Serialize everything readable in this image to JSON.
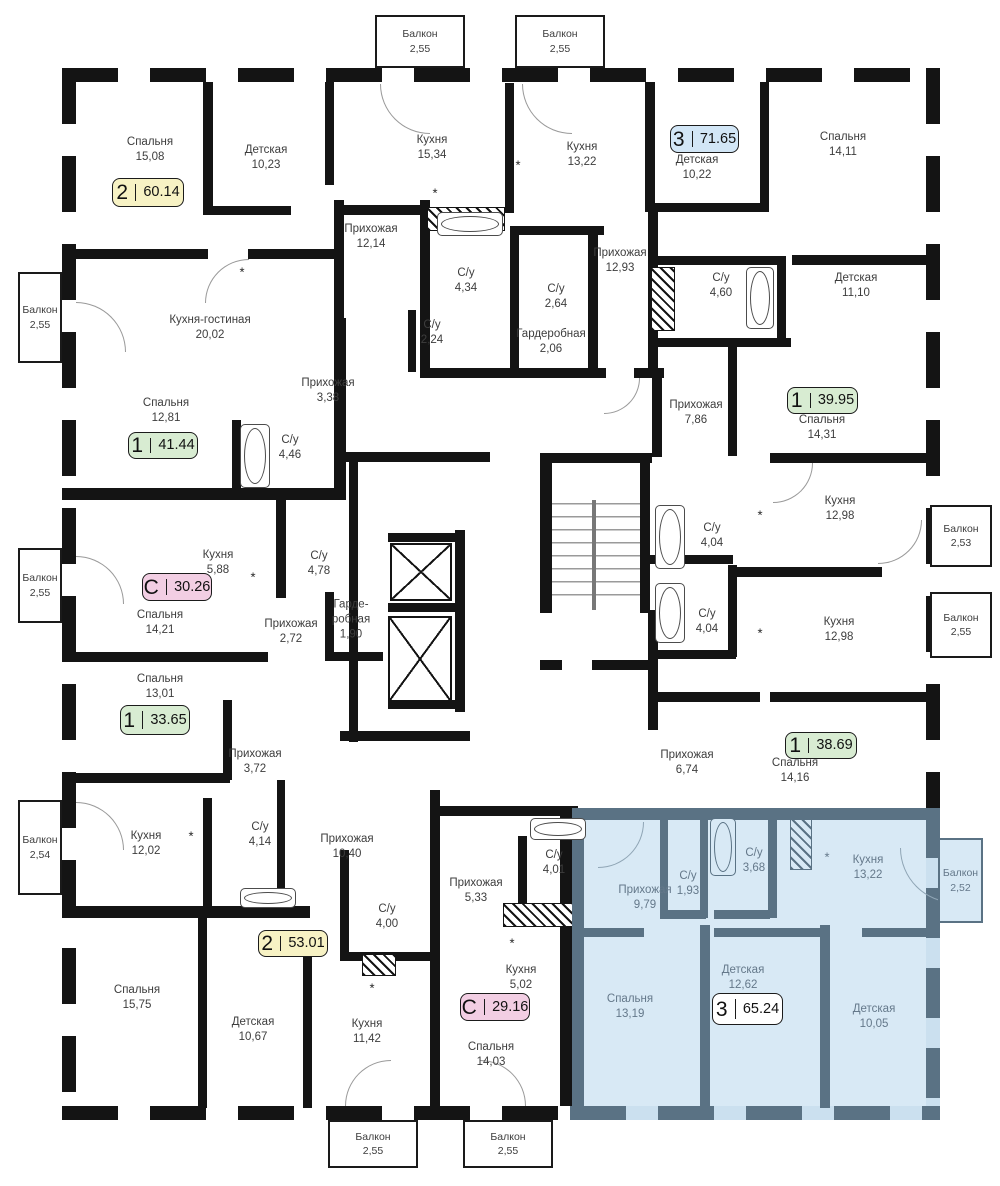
{
  "plan": {
    "wall_color": "#141414",
    "highlight_wall_color": "#5A7284",
    "highlight_fill": "#D8E9F5",
    "label_color": "#3d3d3d",
    "highlight_label_color": "#64788A"
  },
  "apartments": [
    {
      "type": "2",
      "area": "60.14",
      "color": "#F7F2C4",
      "x": 112,
      "y": 178,
      "w": 72,
      "h": 29,
      "highlighted": false
    },
    {
      "type": "3",
      "area": "71.65",
      "color": "#D2E6F6",
      "x": 670,
      "y": 125,
      "w": 69,
      "h": 28,
      "highlighted": false
    },
    {
      "type": "1",
      "area": "41.44",
      "color": "#D8ECD2",
      "x": 128,
      "y": 432,
      "w": 70,
      "h": 27,
      "highlighted": false
    },
    {
      "type": "1",
      "area": "39.95",
      "color": "#D8ECD2",
      "x": 787,
      "y": 387,
      "w": 71,
      "h": 27,
      "highlighted": false
    },
    {
      "type": "С",
      "area": "30.26",
      "color": "#F2CEE3",
      "x": 142,
      "y": 573,
      "w": 70,
      "h": 28,
      "highlighted": false
    },
    {
      "type": "1",
      "area": "33.65",
      "color": "#D8ECD2",
      "x": 120,
      "y": 705,
      "w": 70,
      "h": 30,
      "highlighted": false
    },
    {
      "type": "1",
      "area": "38.69",
      "color": "#D8ECD2",
      "x": 785,
      "y": 732,
      "w": 72,
      "h": 27,
      "highlighted": false
    },
    {
      "type": "2",
      "area": "53.01",
      "color": "#F7F2C4",
      "x": 258,
      "y": 930,
      "w": 70,
      "h": 27,
      "highlighted": false
    },
    {
      "type": "С",
      "area": "29.16",
      "color": "#F2CEE3",
      "x": 460,
      "y": 993,
      "w": 70,
      "h": 28,
      "highlighted": false
    },
    {
      "type": "3",
      "area": "65.24",
      "color": "#FFFFFF",
      "x": 712,
      "y": 993,
      "w": 71,
      "h": 32,
      "highlighted": true
    }
  ],
  "rooms": [
    {
      "name": "Спальня",
      "area": "15,08",
      "x": 150,
      "y": 150,
      "highlighted": false
    },
    {
      "name": "Детская",
      "area": "10,23",
      "x": 266,
      "y": 158,
      "highlighted": false
    },
    {
      "name": "Кухня",
      "area": "15,34",
      "x": 432,
      "y": 148,
      "highlighted": false
    },
    {
      "name": "Кухня",
      "area": "13,22",
      "x": 582,
      "y": 155,
      "highlighted": false
    },
    {
      "name": "Детская",
      "area": "10,22",
      "x": 697,
      "y": 168,
      "highlighted": false
    },
    {
      "name": "Спальня",
      "area": "14,11",
      "x": 843,
      "y": 145,
      "highlighted": false
    },
    {
      "name": "Прихожая",
      "area": "12,14",
      "x": 371,
      "y": 237,
      "highlighted": false
    },
    {
      "name": "Прихожая",
      "area": "12,93",
      "x": 620,
      "y": 261,
      "highlighted": false
    },
    {
      "name": "С/у",
      "area": "4,34",
      "x": 466,
      "y": 281,
      "highlighted": false
    },
    {
      "name": "С/у",
      "area": "2,64",
      "x": 556,
      "y": 297,
      "highlighted": false
    },
    {
      "name": "С/у",
      "area": "4,60",
      "x": 721,
      "y": 286,
      "highlighted": false
    },
    {
      "name": "Детская",
      "area": "11,10",
      "x": 856,
      "y": 286,
      "highlighted": false
    },
    {
      "name": "Кухня-гостиная",
      "area": "20,02",
      "x": 210,
      "y": 328,
      "highlighted": false
    },
    {
      "name": "С/у",
      "area": "2,24",
      "x": 432,
      "y": 333,
      "highlighted": false
    },
    {
      "name": "Гардеробная",
      "area": "2,06",
      "x": 551,
      "y": 342,
      "highlighted": false
    },
    {
      "name": "Прихожая",
      "area": "3,38",
      "x": 328,
      "y": 391,
      "highlighted": false
    },
    {
      "name": "Прихожая",
      "area": "7,86",
      "x": 696,
      "y": 413,
      "highlighted": false
    },
    {
      "name": "Спальня",
      "area": "12,81",
      "x": 166,
      "y": 411,
      "highlighted": false
    },
    {
      "name": "Спальня",
      "area": "14,31",
      "x": 822,
      "y": 428,
      "highlighted": false
    },
    {
      "name": "С/у",
      "area": "4,46",
      "x": 290,
      "y": 448,
      "highlighted": false
    },
    {
      "name": "Кухня",
      "area": "12,98",
      "x": 840,
      "y": 509,
      "highlighted": false
    },
    {
      "name": "С/у",
      "area": "4,04",
      "x": 712,
      "y": 536,
      "highlighted": false
    },
    {
      "name": "Кухня",
      "area": "5,88",
      "x": 218,
      "y": 563,
      "highlighted": false
    },
    {
      "name": "С/у",
      "area": "4,78",
      "x": 319,
      "y": 564,
      "highlighted": false
    },
    {
      "name": "Спальня",
      "area": "14,21",
      "x": 160,
      "y": 623,
      "highlighted": false
    },
    {
      "name": "Прихожая",
      "area": "2,72",
      "x": 291,
      "y": 632,
      "highlighted": false
    },
    {
      "name": "Гарде-\nробная",
      "area": "1,90",
      "x": 351,
      "y": 620,
      "highlighted": false
    },
    {
      "name": "С/у",
      "area": "4,04",
      "x": 707,
      "y": 622,
      "highlighted": false
    },
    {
      "name": "Кухня",
      "area": "12,98",
      "x": 839,
      "y": 630,
      "highlighted": false
    },
    {
      "name": "Спальня",
      "area": "13,01",
      "x": 160,
      "y": 687,
      "highlighted": false
    },
    {
      "name": "Прихожая",
      "area": "3,72",
      "x": 255,
      "y": 762,
      "highlighted": false
    },
    {
      "name": "Прихожая",
      "area": "6,74",
      "x": 687,
      "y": 763,
      "highlighted": false
    },
    {
      "name": "Спальня",
      "area": "14,16",
      "x": 795,
      "y": 771,
      "highlighted": false
    },
    {
      "name": "Кухня",
      "area": "12,02",
      "x": 146,
      "y": 844,
      "highlighted": false
    },
    {
      "name": "С/у",
      "area": "4,14",
      "x": 260,
      "y": 835,
      "highlighted": false
    },
    {
      "name": "Прихожая",
      "area": "10,40",
      "x": 347,
      "y": 847,
      "highlighted": false
    },
    {
      "name": "С/у",
      "area": "4,00",
      "x": 387,
      "y": 917,
      "highlighted": false
    },
    {
      "name": "Прихожая",
      "area": "5,33",
      "x": 476,
      "y": 891,
      "highlighted": false
    },
    {
      "name": "С/у",
      "area": "4,01",
      "x": 554,
      "y": 863,
      "highlighted": false
    },
    {
      "name": "Кухня",
      "area": "5,02",
      "x": 521,
      "y": 978,
      "highlighted": false
    },
    {
      "name": "Спальня",
      "area": "15,75",
      "x": 137,
      "y": 998,
      "highlighted": false
    },
    {
      "name": "Детская",
      "area": "10,67",
      "x": 253,
      "y": 1030,
      "highlighted": false
    },
    {
      "name": "Кухня",
      "area": "11,42",
      "x": 367,
      "y": 1032,
      "highlighted": false
    },
    {
      "name": "Спальня",
      "area": "14,03",
      "x": 491,
      "y": 1055,
      "highlighted": false
    },
    {
      "name": "Прихожая",
      "area": "9,79",
      "x": 645,
      "y": 898,
      "highlighted": true
    },
    {
      "name": "С/у",
      "area": "1,93",
      "x": 688,
      "y": 884,
      "highlighted": true
    },
    {
      "name": "С/у",
      "area": "3,68",
      "x": 754,
      "y": 861,
      "highlighted": true
    },
    {
      "name": "Кухня",
      "area": "13,22",
      "x": 868,
      "y": 868,
      "highlighted": true
    },
    {
      "name": "Спальня",
      "area": "13,19",
      "x": 630,
      "y": 1007,
      "highlighted": true
    },
    {
      "name": "Детская",
      "area": "12,62",
      "x": 743,
      "y": 978,
      "highlighted": true
    },
    {
      "name": "Детская",
      "area": "10,05",
      "x": 874,
      "y": 1017,
      "highlighted": true
    }
  ],
  "balconies": [
    {
      "name": "Балкон",
      "area": "2,55",
      "x": 375,
      "y": 15,
      "w": 90,
      "h": 53,
      "highlighted": false
    },
    {
      "name": "Балкон",
      "area": "2,55",
      "x": 515,
      "y": 15,
      "w": 90,
      "h": 53,
      "highlighted": false
    },
    {
      "name": "Балкон",
      "area": "2,55",
      "x": 18,
      "y": 272,
      "w": 44,
      "h": 91,
      "highlighted": false
    },
    {
      "name": "Балкон",
      "area": "2,55",
      "x": 18,
      "y": 548,
      "w": 44,
      "h": 75,
      "highlighted": false
    },
    {
      "name": "Балкон",
      "area": "2,54",
      "x": 18,
      "y": 800,
      "w": 44,
      "h": 95,
      "highlighted": false
    },
    {
      "name": "Балкон",
      "area": "2,53",
      "x": 930,
      "y": 505,
      "w": 62,
      "h": 62,
      "highlighted": false
    },
    {
      "name": "Балкон",
      "area": "2,55",
      "x": 930,
      "y": 592,
      "w": 62,
      "h": 66,
      "highlighted": false
    },
    {
      "name": "Балкон",
      "area": "2,55",
      "x": 328,
      "y": 1120,
      "w": 90,
      "h": 48,
      "highlighted": false
    },
    {
      "name": "Балкон",
      "area": "2,55",
      "x": 463,
      "y": 1120,
      "w": 90,
      "h": 48,
      "highlighted": false
    },
    {
      "name": "Балкон",
      "area": "2,52",
      "x": 938,
      "y": 838,
      "w": 45,
      "h": 85,
      "highlighted": true
    }
  ],
  "fixtures": {
    "asterisks": [
      {
        "x": 242,
        "y": 272,
        "highlighted": false
      },
      {
        "x": 435,
        "y": 193,
        "highlighted": false
      },
      {
        "x": 518,
        "y": 165,
        "highlighted": false
      },
      {
        "x": 253,
        "y": 577,
        "highlighted": false
      },
      {
        "x": 760,
        "y": 515,
        "highlighted": false
      },
      {
        "x": 191,
        "y": 836,
        "highlighted": false
      },
      {
        "x": 760,
        "y": 633,
        "highlighted": false
      },
      {
        "x": 372,
        "y": 988,
        "highlighted": false
      },
      {
        "x": 512,
        "y": 943,
        "highlighted": false
      },
      {
        "x": 827,
        "y": 857,
        "highlighted": true
      }
    ],
    "bathtubs": [
      {
        "x": 437,
        "y": 212,
        "w": 66,
        "h": 24,
        "highlighted": false
      },
      {
        "x": 240,
        "y": 424,
        "w": 30,
        "h": 64,
        "highlighted": false
      },
      {
        "x": 746,
        "y": 267,
        "w": 28,
        "h": 62,
        "highlighted": false
      },
      {
        "x": 655,
        "y": 505,
        "w": 30,
        "h": 64,
        "highlighted": false
      },
      {
        "x": 655,
        "y": 583,
        "w": 30,
        "h": 60,
        "highlighted": false
      },
      {
        "x": 530,
        "y": 818,
        "w": 56,
        "h": 22,
        "highlighted": false
      },
      {
        "x": 240,
        "y": 888,
        "w": 56,
        "h": 20,
        "highlighted": false
      },
      {
        "x": 710,
        "y": 818,
        "w": 26,
        "h": 58,
        "highlighted": true
      }
    ]
  }
}
